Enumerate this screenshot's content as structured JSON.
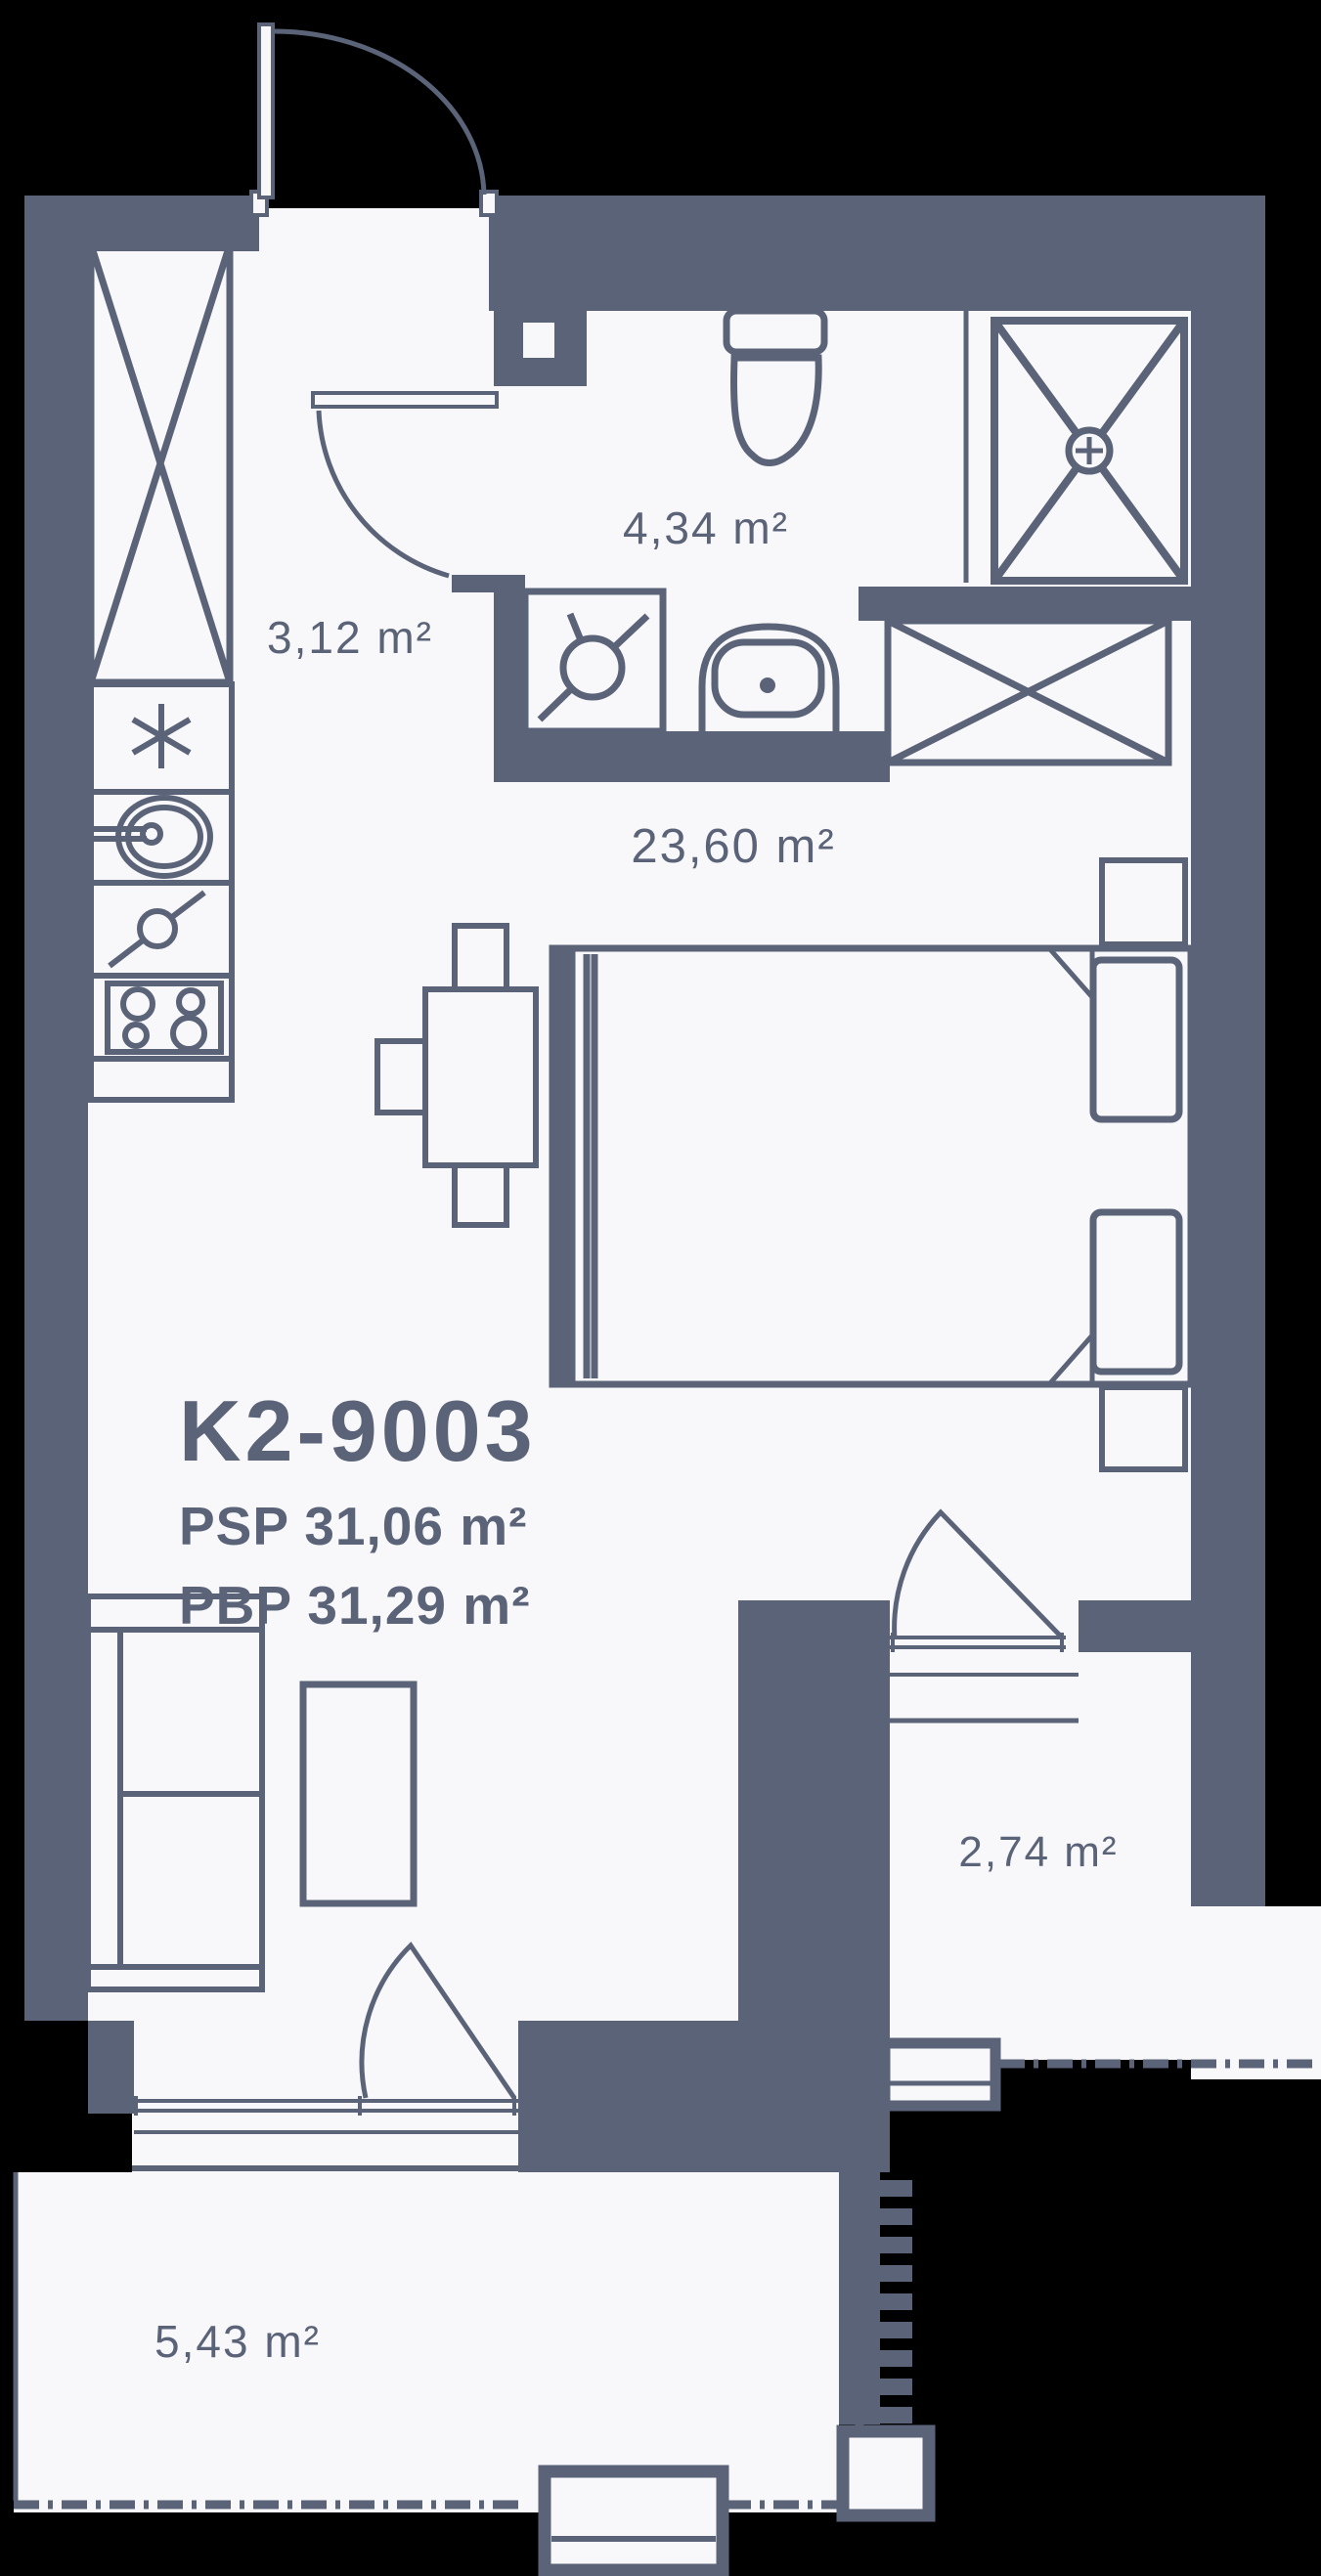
{
  "plan": {
    "unit_id": "K2-9003",
    "psp_label": "PSP 31,06 m²",
    "pbp_label": "PBP 31,29 m²"
  },
  "rooms": {
    "hallway": {
      "area": "3,12 m²"
    },
    "bathroom": {
      "area": "4,34 m²"
    },
    "living": {
      "area": "23,60 m²"
    },
    "balcony_side": {
      "area": "2,74 m²"
    },
    "balcony_bottom": {
      "area": "5,43 m²"
    }
  },
  "fixtures": [
    "entry-door",
    "bathroom-door",
    "balcony-door",
    "wardrobe-x",
    "fridge",
    "kitchen-sink",
    "cooktop-valve",
    "stove",
    "toilet",
    "washing-machine",
    "bathroom-sink",
    "shower",
    "bed",
    "pillow",
    "nightstand",
    "dining-table",
    "chair",
    "sofa",
    "coffee-table",
    "air-conditioner",
    "balcony-railing"
  ],
  "colors": {
    "ink": "#5b6378",
    "floor": "#f8f8fa",
    "bg": "#000000"
  }
}
